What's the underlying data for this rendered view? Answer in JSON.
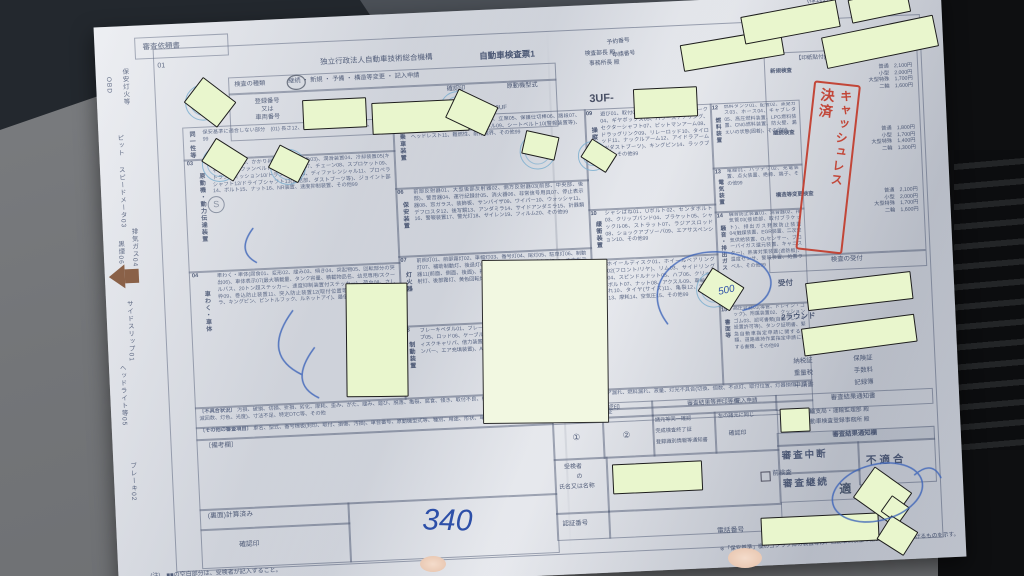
{
  "colors": {
    "redact_fill": "#e9f6cd",
    "stamp_red": "#c23b2b",
    "pen_blue": "#2d4fa8",
    "seal_blue": "#78acce",
    "arrow_brown": "#8a6148"
  },
  "left_margin": {
    "request": "審査依頼書",
    "code": "01",
    "items": [
      "保安灯火等",
      "OBD",
      "ピット",
      "スピードメータ03",
      "排気ガス04",
      "黒煙06",
      "サイドスリップ01",
      "ヘッドライト等05",
      "ブレーキ02"
    ]
  },
  "header": {
    "org": "独立行政法人自動車技術総合機構",
    "to1": "検査部長 殿",
    "to2": "事務所長 殿",
    "form_note": "(様式1)",
    "go": "号",
    "title": "自動車検査票1",
    "type_label": "検査の種類",
    "type_options": "継続 ・ 新規 ・ 予備 ・ 構造等変更 ・ 記入申請",
    "reg_label": "登録番号\n又は\n車両番号",
    "confirm_label": "確認印",
    "engine_label": "原動機型式",
    "engine_value": "3UF",
    "chassis_prefix": "3UF-",
    "reserve_label": "予約番号",
    "apply_label": "申請番号",
    "fee_slip": "検査手数料納付書"
  },
  "sections": {
    "s01": {
      "label": "同一性等",
      "body": "保安基準に適合しない部分　(01) 長さ12、幅13、高さ14、車両重量15、その他99"
    },
    "s03": {
      "num": "03",
      "label": "原動機・動力伝達装置",
      "body": "原動機(異音01、かかり具合02、排気の色03)、潤滑装置04、冷却装置05(キャップ等)、ファンベルト06、クラッチ07、チェーン08、スプロケット09、トランスミッション10/トランスファ10、ディファレンシャル11、プロペラシャフト12/ドライブシャフト13(連結部、ダストブーツ等)、ジョイント部14、ボルト15、ナット16、NR装置、速度抑制装置、その他99"
    },
    "s04": {
      "num": "04",
      "label": "車わく・車体",
      "body": "車わく・車体(腐食01、変形02、緩み03、傾き04、突起物05、回転部分の突出06)、車体表示07(最大積載量、タンク容量、積載物品名、幼児専用/スクールバス、20トン超ステッカー、速度抑制装置付ステッカー)、荷台08、さし枠09、巻込防止装置11、突入防止装置12(取付位置等)、連結装置13(カプラ、キングピン、ピントルフック、ルネットアイ)、最低地上高、その他99"
    },
    "s05": {
      "num": "05",
      "label": "乗車装置",
      "body": "座席01、定員02、座面03、通路04、立席05、保護仕切棒06、踏段07、室内灯08、インストルメントパネル09、シートベルト10(警報装置等)、ヘッドレスト11、難燃性、前方視界、その他99"
    },
    "s06": {
      "num": "06",
      "label": "保安装置",
      "body": "前部反射器01、大型後部反射器02、側方反射器03(前部、中央部、後部)、警音器04、運行記録計05、消火器06、非常信号用具07、停止表示器08、窓ガラス、装飾板、サンバイザ09、ワイパー10、ウォッシャ11、デフロスタ12、後写鏡13、アンダミラ14、サイドアンダミラ15、計器類16、警報装置17、警光灯18、サイレン19、フィルム20、その他99"
    },
    "s07": {
      "num": "07",
      "label": "灯火器",
      "body": "前照灯01、前部霧灯02、車幅灯03、番号灯04、尾灯05、駐車灯06、制動灯07、補助制動灯、後退灯08、側方灯09、非常点滅表示灯10、方向指示器11(前面、側面、後面)、補助方向指示器12、速度表示装置13、側方照射灯、後部霧灯、黄色回転灯、制限灯、後部上側端灯、その他99"
    },
    "s08": {
      "num": "08",
      "label": "制動装置",
      "body": "ブレーキペダル01、ブレーキレバー02、ラチェット03、ホース04、パイプ05、ロッド06、ケーブル07、マスタシリンダ08、ホイルシリンダ、ディスクキャリパ、倍力装置09、センタブレーキ10、エアブレーキ11(チャンバー、エア充填装置)、ABS装置、リザーバタンク液量、その他99"
    },
    "s09": {
      "num": "09",
      "label": "操縦装置",
      "body": "遊び01、取付02、ハンドル03、かじ取ホーク04、ギヤボックス05、パワーステアリング、セクターシャフト07、ピットマンアーム08、ドラッグリンク09、リレーロッド10、タイロッド11、ナックルアーム12、アイドラアーム13(ダストブーツ)、キングピン14、ラックブーツ、その他99"
    },
    "s10": {
      "num": "10",
      "label": "緩衝装置",
      "body": "シャシばね01、Uボルト02、センタボルト03、クリップバンド04、ブラケット05、シャックル06、ストラット07、ラジアスロッド08、ショックアブソーバ09、エアサスペンション10、その他99"
    },
    "s11": {
      "num": "11",
      "label": "走行装置",
      "body": "ホイールディスク01、ホイールベアリング02(フロント/リヤ)、リム03、サイドリング04、スピンドルナット05、ハブ06、クリップボルト07、ナット08、アクスル09、車輪の振れ10、タイヤ(サイズ)11、亀裂12、溝深さ13、摩耗14、空気圧15、その他99"
    },
    "s12": {
      "num": "12",
      "label": "燃料装置",
      "body": "燃料タンク01、配管02、蒸発ガス03、ホース04、キャブレタ05、高圧燃料装置、LPG燃料装置、CNG燃料装置、防火壁、漏えいの状態(固着)、その他99"
    },
    "s13": {
      "num": "13",
      "label": "電気装置",
      "body": "電線01、バッテリ02、充電装置、点火装置、絶縁、端子、その他99"
    },
    "s14": {
      "num": "14",
      "label": "騒音・排出ガス",
      "body": "騒音防止装置01、消音器02、排気管03(接続部、取付ブラケット)、排出ガス発散防止装置04(触媒装置、EGR装置、二次空気供給装置、O₂センサー、ブローバイガス還元装置、キャニスター)、熱害対策装置(遮熱板)、温度センサ、警報装置、処置ラベル、その他99"
    },
    "s15": {
      "num": "15",
      "label": "書面等",
      "body": "高圧容器01(導管、ドレイン・コック)、附属装置02、クッションゴム03、認可書類(自動ブレーキ設置許可等)、タンク証明書、緊急自動車指定申請に関する書類、道路維持作業指定申請に関する書類、その他99"
    }
  },
  "defects": {
    "label": "〔不具合状況〕",
    "text": "汚損、破損、切損、折損、劣化、摩耗、歪み、がた、緩み、遊び、脱落、亀裂、腐食、傾き、取付不良、機能不良、損傷、曲がり、油漏れ、水漏れ、ガス・エア漏れ、燃料漏れ、液量、灯光不具合(切換、個数、不点灯、取付位置、灯器損傷、点滅回数、灯色、光度)、寸法不足、特定DTC等、その他"
  },
  "other_items": {
    "label": "〔その他の審査項目〕",
    "text": "車名、型式、番号標板(封印、取付、損傷、汚損)、車台番号、原動機型式等、種別、用途、形状、車体表示(制限車両、ダンプ番号)、自重計、自重計適合証"
  },
  "fee": {
    "header": "【印紙貼付(印)】",
    "groups": [
      {
        "name": "新規検査",
        "lines": "普通　2,100円\n小型　2,000円\n大型特殊　1,700円\n二輪　1,600円"
      },
      {
        "name": "継続検査",
        "lines": "普通　1,800円\n小型　1,700円\n大型特殊　1,400円\n二輪　1,300円"
      },
      {
        "name": "構造等変更検査",
        "lines": "普通　2,100円\n小型　2,000円\n大型特殊　1,700円\n二輪　1,600円"
      }
    ]
  },
  "receipt": {
    "header": "検査の受付",
    "label": "受付",
    "round": "2ラウンド",
    "warning": "未受付の車両は受検できません",
    "docs1": "納税証",
    "docs2": "保険証",
    "docs3": "重量税",
    "docs4": "手数料",
    "docs5": "申請書",
    "docs6": "記録簿"
  },
  "result": {
    "notice": "審査結果通知書",
    "to1": "運輸支局・運輸監理部 殿",
    "to2": "自動車検査登録事務所 殿",
    "column": "審査結果通知欄",
    "interrupt": "審査中断",
    "cont": "審査継続",
    "fail": "不適合",
    "pass": "適",
    "precheck": "前検査"
  },
  "reentry": {
    "title": "再入場確認印",
    "c1": "①",
    "c2": "②"
  },
  "stamp_col": {
    "title": "審査結果等押印等欄",
    "l1": "諸元等同一確認",
    "l2": "完成検査終了証",
    "l3": "登録識別情報等通知書",
    "same": "左の諸元に同じ",
    "confirm": "確認印",
    "entry": "記入申請",
    "entry_confirm": "確認印"
  },
  "bottom": {
    "remarks": "〔備考欄〕",
    "calc": "(裏面)計算済み",
    "confirm": "確認印",
    "name1": "受検者",
    "name2": "の",
    "name3": "氏名又は名称",
    "auth": "認証番号",
    "phone": "電話番号"
  },
  "handwriting": {
    "number": "340",
    "note": "500"
  },
  "stamps": {
    "cashless1": "キャッシュレス",
    "cashless2": "決済",
    "s_mark": "S"
  },
  "notes": {
    "n1": "(注)　■■の空白部分は、受検者が記入すること。",
    "n2": "※「保安基準」欄のゴシック体の装置等は、自動車点検基準第5条別表第8に掲げるものを示す。"
  }
}
